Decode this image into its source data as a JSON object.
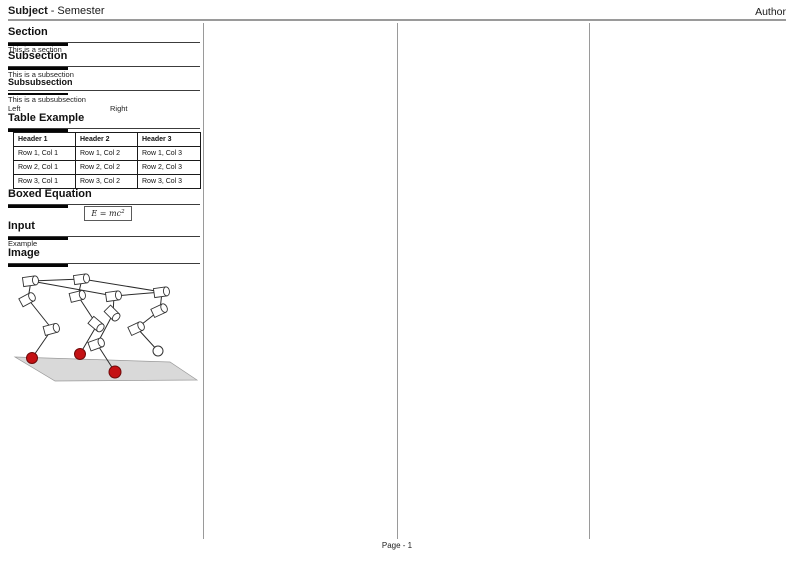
{
  "header": {
    "subject": "Subject",
    "separator": "-",
    "semester": "Semester",
    "author": "Author"
  },
  "content": {
    "section": {
      "title": "Section",
      "body": "This is a section"
    },
    "subsection": {
      "title": "Subsection",
      "body": "This is a subsection"
    },
    "subsubsection": {
      "title": "Subsubsection",
      "body": "This is a subsubsection"
    },
    "two_columns": {
      "left": "Left",
      "right": "Right"
    },
    "table_example": {
      "title": "Table Example",
      "headers": [
        "Header 1",
        "Header 2",
        "Header 3"
      ],
      "rows": [
        [
          "Row 1, Col 1",
          "Row 1, Col 2",
          "Row 1, Col 3"
        ],
        [
          "Row 2, Col 1",
          "Row 2, Col 2",
          "Row 2, Col 3"
        ],
        [
          "Row 3, Col 1",
          "Row 3, Col 2",
          "Row 3, Col 3"
        ]
      ]
    },
    "boxed_equation": {
      "title": "Boxed Equation",
      "base": "E = mc",
      "exponent": "2"
    },
    "input": {
      "title": "Input",
      "body": "Example"
    },
    "image": {
      "title": "Image",
      "alt": "quadruped-robot-kinematic-sketch",
      "colors": {
        "stance_foot": "#c41114",
        "stance_foot_outline": "#6e0a0a",
        "swing_foot": "#ffffff",
        "ground": "#d9d9d9",
        "ground_outline": "#999999",
        "outline": "#333333"
      }
    }
  },
  "footer": {
    "page_label": "Page - 1"
  }
}
